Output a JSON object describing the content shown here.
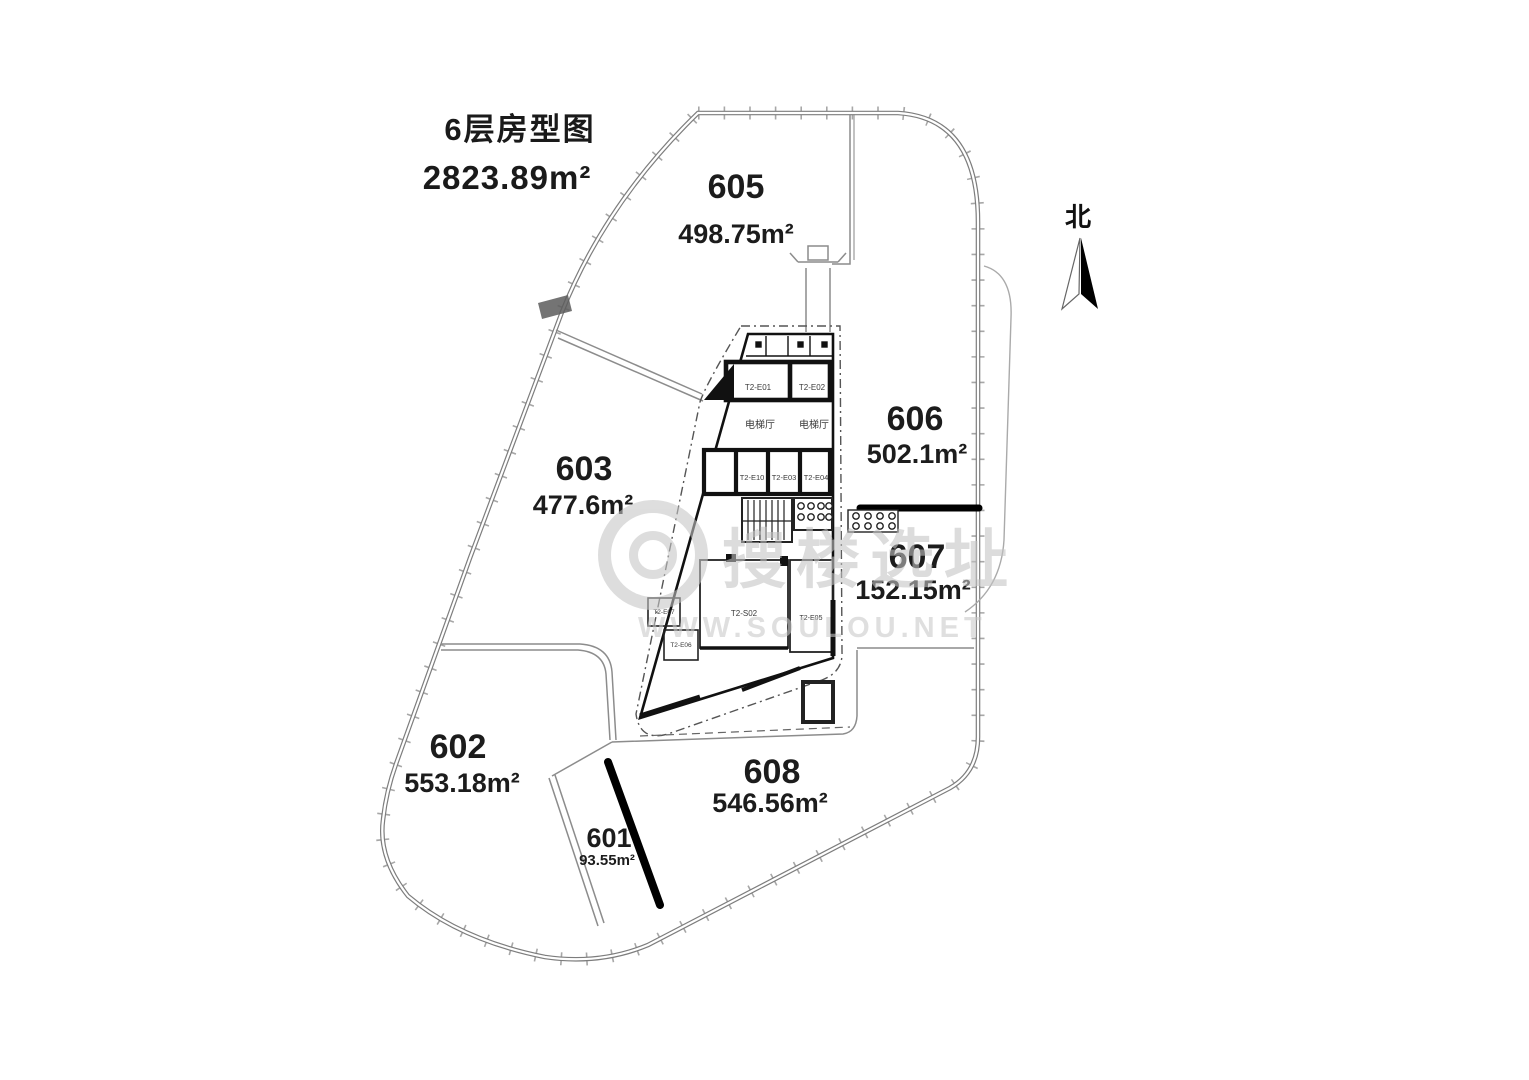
{
  "title": {
    "floor": "6层房型图",
    "total_area": "2823.89m²"
  },
  "compass": {
    "north_label": "北"
  },
  "watermark": {
    "brand": "搜楼选址",
    "url": "WWW.SOULOU.NET"
  },
  "units": {
    "u605": {
      "id": "605",
      "area": "498.75m²"
    },
    "u603": {
      "id": "603",
      "area": "477.6m²"
    },
    "u606": {
      "id": "606",
      "area": "502.1m²"
    },
    "u607": {
      "id": "607",
      "area": "152.15m²"
    },
    "u602": {
      "id": "602",
      "area": "553.18m²"
    },
    "u601": {
      "id": "601",
      "area": "93.55m²"
    },
    "u608": {
      "id": "608",
      "area": "546.56m²"
    }
  },
  "core": {
    "labels": {
      "lobby1": "电梯厅",
      "lobby2": "电梯厅",
      "e01": "T2-E01",
      "e02": "T2-E02",
      "e10": "T2-E10",
      "e03": "T2-E03",
      "e04": "T2-E04",
      "s02": "T2-S02",
      "e05": "T2-E05",
      "e06": "T2-E06",
      "e07": "T2-E07"
    }
  },
  "colors": {
    "outline": "#7d7d7d",
    "wall": "#111111",
    "divider": "#000000",
    "watermark": "#c6c6c6"
  }
}
